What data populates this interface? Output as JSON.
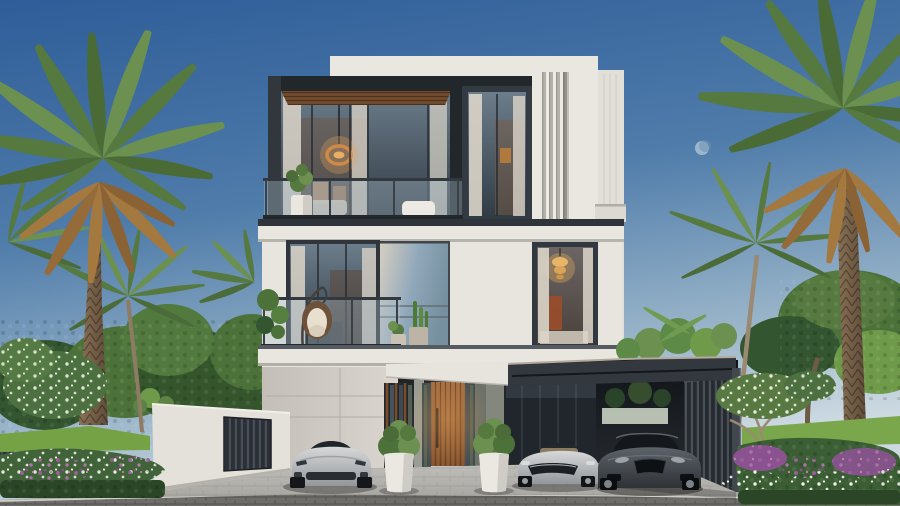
{
  "scene": {
    "description": "Daytime 3D architectural rendering of a modern three-storey luxury villa with glass balconies, palm trees, landscaped flower gardens and three luxury cars parked by the entrance",
    "building": {
      "storeys_visible": 3,
      "features": [
        "glass balustrade balconies",
        "wood slat soffit",
        "vertical louver fin panel",
        "wood slat entry door",
        "dark glass curtain wall",
        "cantilevered carport canopy",
        "vertical slat carport wall",
        "white boundary wall with dark slat gate"
      ]
    },
    "interior_lights": [
      "round pendant ring light on top floor",
      "crystal chandelier on middle floor"
    ],
    "balcony_items": [
      "hanging egg chair",
      "white planter with plant",
      "potted cacti",
      "white throw seat"
    ],
    "vehicles": {
      "count": 3,
      "items": [
        "silver sports coupe",
        "silver open-top grand tourer",
        "dark grey sports coupe under carport"
      ]
    },
    "vegetation": [
      "two large date palms",
      "coconut palms",
      "leafy background trees",
      "white frangipani blossoms",
      "purple and white flower beds",
      "green lawn",
      "boxwood balls in white pots"
    ],
    "sky": {
      "condition": "clear gradient blue",
      "moon_visible": true
    }
  },
  "colors": {
    "sky_top": "#2e5d99",
    "sky_mid": "#4f7caa",
    "sky_low": "#9ab5c9",
    "sky_horizon": "#ccd9e1",
    "wall_white": "#eae7e0",
    "wall_shade": "#d9d6cf",
    "tower": "#e2dfd8",
    "charcoal": "#32383e",
    "charcoal_dark": "#22272c",
    "wood_soffit": "#6f4a2c",
    "wood_door": "#8a5733",
    "glass_cool": "#7d93a5",
    "glass_dark": "#20262c",
    "curtain": "#dcd5c9",
    "warm_glow": "#d99a57",
    "palm_green": "#55793f",
    "palm_green_light": "#6c9050",
    "palm_brown": "#a3793f",
    "trunk": "#7d6148",
    "tree_dark": "#33552f",
    "tree_mid": "#4c7239",
    "tree_light": "#6f9a4a",
    "lawn": "#75a244",
    "flower_purple": "#9a5d9e",
    "flower_white": "#eef0e6",
    "paver_apron": "#b2b0ab",
    "road": "#6e6d6a",
    "car_silver": "#c2c4c6",
    "car_dark": "#4a4f55"
  }
}
